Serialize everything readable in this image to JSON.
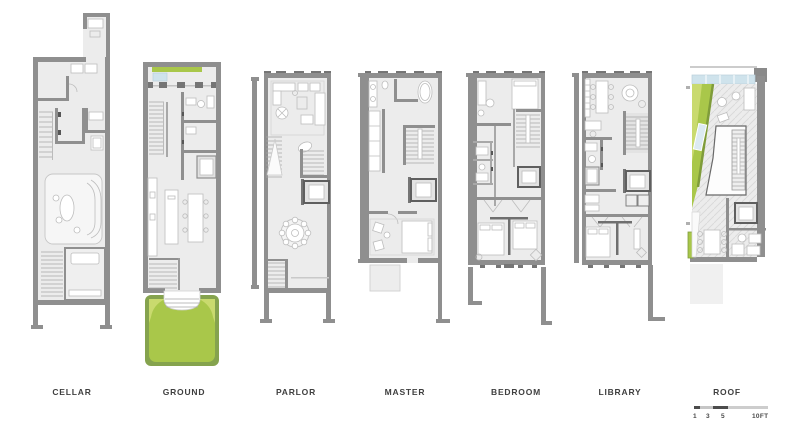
{
  "plans": [
    {
      "id": "cellar",
      "label": "CELLAR"
    },
    {
      "id": "ground",
      "label": "GROUND"
    },
    {
      "id": "parlor",
      "label": "PARLOR"
    },
    {
      "id": "master",
      "label": "MASTER"
    },
    {
      "id": "bedroom",
      "label": "BEDROOM"
    },
    {
      "id": "library",
      "label": "LIBRARY"
    },
    {
      "id": "roof",
      "label": "ROOF"
    }
  ],
  "scale_bar": {
    "ticks": [
      "1",
      "3",
      "5"
    ],
    "end_label": "10FT"
  },
  "colors": {
    "wall": "#8f8f8f",
    "wall_dark": "#757575",
    "floor": "#ececec",
    "furniture_line": "#bdbdbd",
    "stair_line": "#a8a8a8",
    "green_border": "#85a34e",
    "green_fill": "#a9c74a",
    "green_light": "#c9da6e",
    "sky_blue": "#cfe3ec",
    "label_text": "#3f3f3f"
  }
}
